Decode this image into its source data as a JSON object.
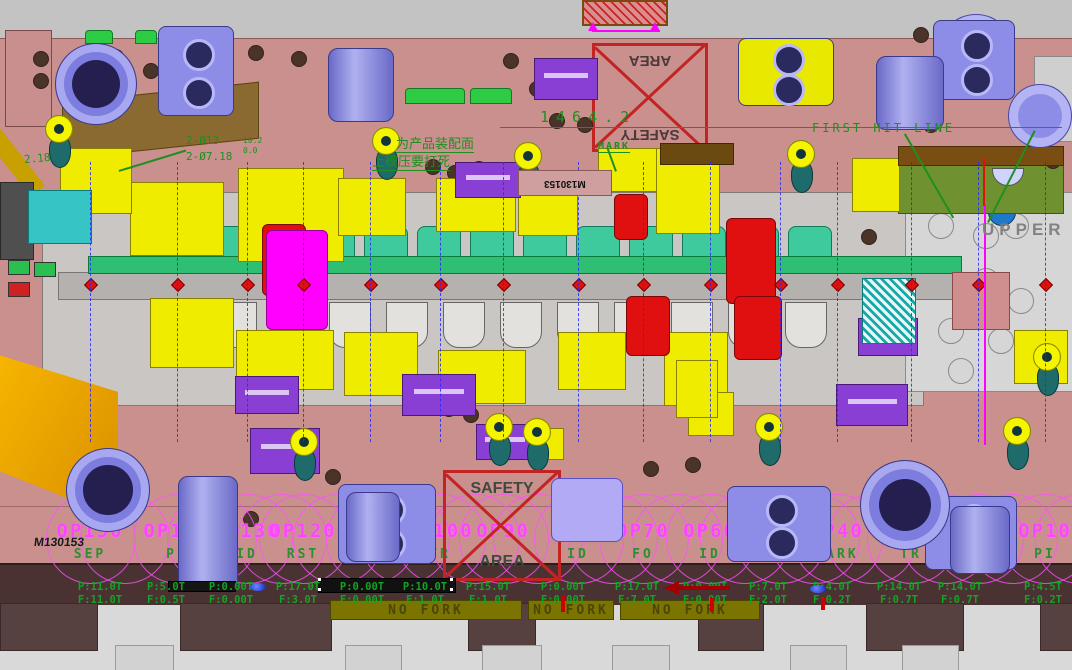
{
  "view": {
    "description": "progressive stamping die 3D CAD top view",
    "colors": {
      "background": "#c3c3c3",
      "die_plate_pink": "#c9908e",
      "base_maroon": "#4a3132",
      "yellow_block": "#f0ec00",
      "strip_green": "#2fbf72",
      "punch_teal": "#3fca9e",
      "magenta": "#ff00ff",
      "red": "#e01010",
      "purple_fixture": "#8d8de8",
      "annotation_green": "#1f8f1f",
      "station_magenta": "#ff44ff",
      "olive": "#6f9130",
      "orange_wedge": "#f2a800"
    }
  },
  "annotations": {
    "overall_dim": "1464.2",
    "mark": "MARK",
    "first_hit_line": "FIRST HIT LINE",
    "upper": "UPPER",
    "safety_word_1": "SAFETY",
    "safety_word_2": "AREA",
    "note_cn_1": "为产品装配面",
    "note_cn_2": "上模压要打死",
    "hole_callout_1": "2-Ø13",
    "hole_callout_2": "2-Ø7.18",
    "small_dim_1": "10.2",
    "small_dim_2": "0.0",
    "small_dim_3": "2.18",
    "die_number": "M130153",
    "die_number_plate": "M130153",
    "no_fork": "NO FORK"
  },
  "stations": [
    {
      "op": "OP150",
      "type": "SEP",
      "press": "P:11.0T",
      "force": "F:11.0T"
    },
    {
      "op": "OP140",
      "type": "PI",
      "press": "P:5.0T",
      "force": "F:0.5T"
    },
    {
      "op": "OP130",
      "type": "ID",
      "press": "P:0.00T",
      "force": "F:0.00T"
    },
    {
      "op": "OP120",
      "type": "RST",
      "press": "P:17.0T",
      "force": "F:3.0T"
    },
    {
      "op": "OP110",
      "type": "",
      "press": "P:0.00T",
      "force": "F:0.00T"
    },
    {
      "op": "OP100",
      "type": "TR",
      "press": "P:10.0T",
      "force": "F:1.0T"
    },
    {
      "op": "OP90",
      "type": "",
      "press": "P:15.0T",
      "force": "F:1.0T"
    },
    {
      "op": "OP80",
      "type": "ID",
      "press": "P:0.00T",
      "force": "F:0.00T"
    },
    {
      "op": "OP70",
      "type": "FO",
      "press": "P:17.0T",
      "force": "F:7.0T"
    },
    {
      "op": "OP60",
      "type": "ID",
      "press": "P:0.00T",
      "force": "F:0.00T"
    },
    {
      "op": "OP50",
      "type": "FO",
      "press": "P:7.0T",
      "force": "F:2.0T"
    },
    {
      "op": "OP40",
      "type": "MARK",
      "press": "P:4.0T",
      "force": "F:0.2T"
    },
    {
      "op": "OP30",
      "type": "TR",
      "press": "P:14.0T",
      "force": "F:0.7T"
    },
    {
      "op": "OP20",
      "type": "TR",
      "press": "P:14.0T",
      "force": "F:0.7T"
    },
    {
      "op": "OP10",
      "type": "PI",
      "press": "P:4.5T",
      "force": "F:0.2T"
    }
  ]
}
